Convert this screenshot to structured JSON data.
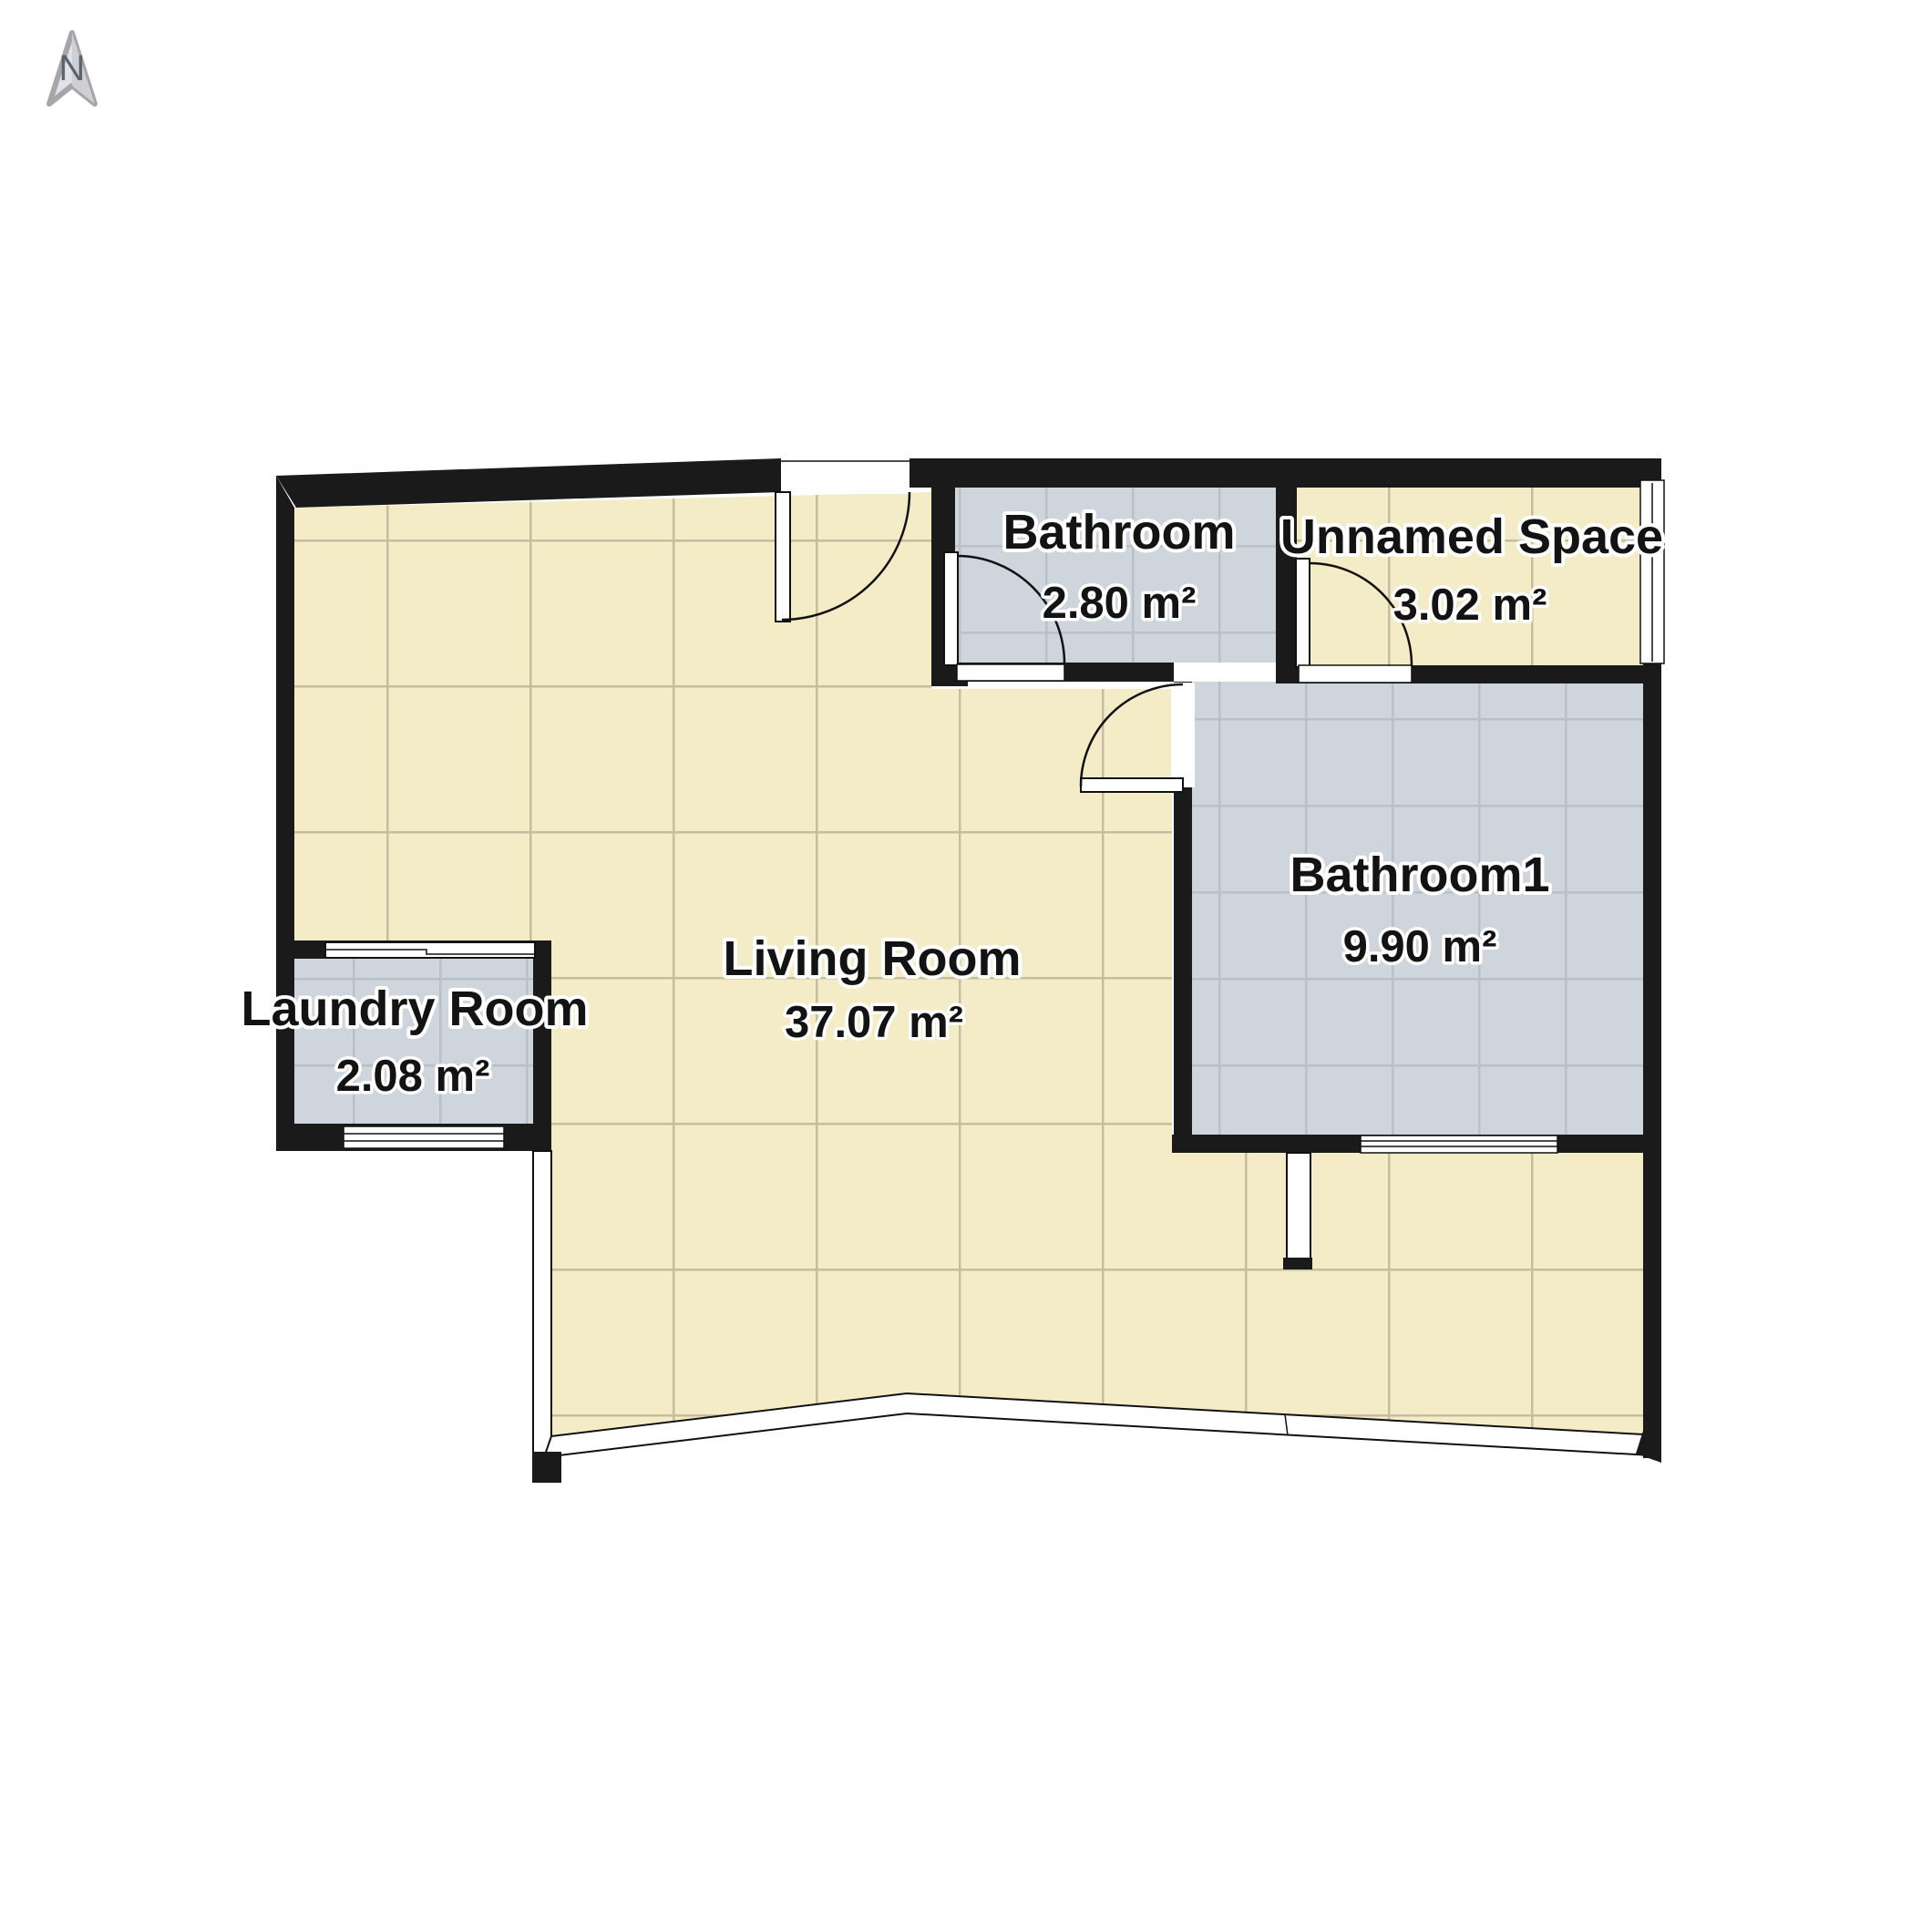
{
  "title": "Apartment floor plan",
  "compass": {
    "label": "N"
  },
  "rooms": [
    {
      "id": "living-room",
      "name": "Living Room",
      "area": "37.07 m²",
      "floor": "cream-tile"
    },
    {
      "id": "bathroom",
      "name": "Bathroom",
      "area": "2.80 m²",
      "floor": "gray-tile"
    },
    {
      "id": "unnamed-space",
      "name": "Unnamed Space",
      "area": "3.02 m²",
      "floor": "cream-tile"
    },
    {
      "id": "bathroom1",
      "name": "Bathroom1",
      "area": "9.90 m²",
      "floor": "gray-tile"
    },
    {
      "id": "laundry-room",
      "name": "Laundry Room",
      "area": "2.08 m²",
      "floor": "gray-tile"
    }
  ],
  "colors": {
    "background": "#ffffff",
    "wall": "#1a1a1a",
    "cream_floor": "#f4ebc7",
    "cream_grout": "#c6bda1",
    "gray_floor": "#cfd5dd",
    "gray_grout": "#b9c0c8",
    "compass_fill": "#e2e2e6",
    "compass_shade": "#cfcfd4",
    "compass_border": "#a6a6aa",
    "compass_letter": "#5a6470"
  }
}
